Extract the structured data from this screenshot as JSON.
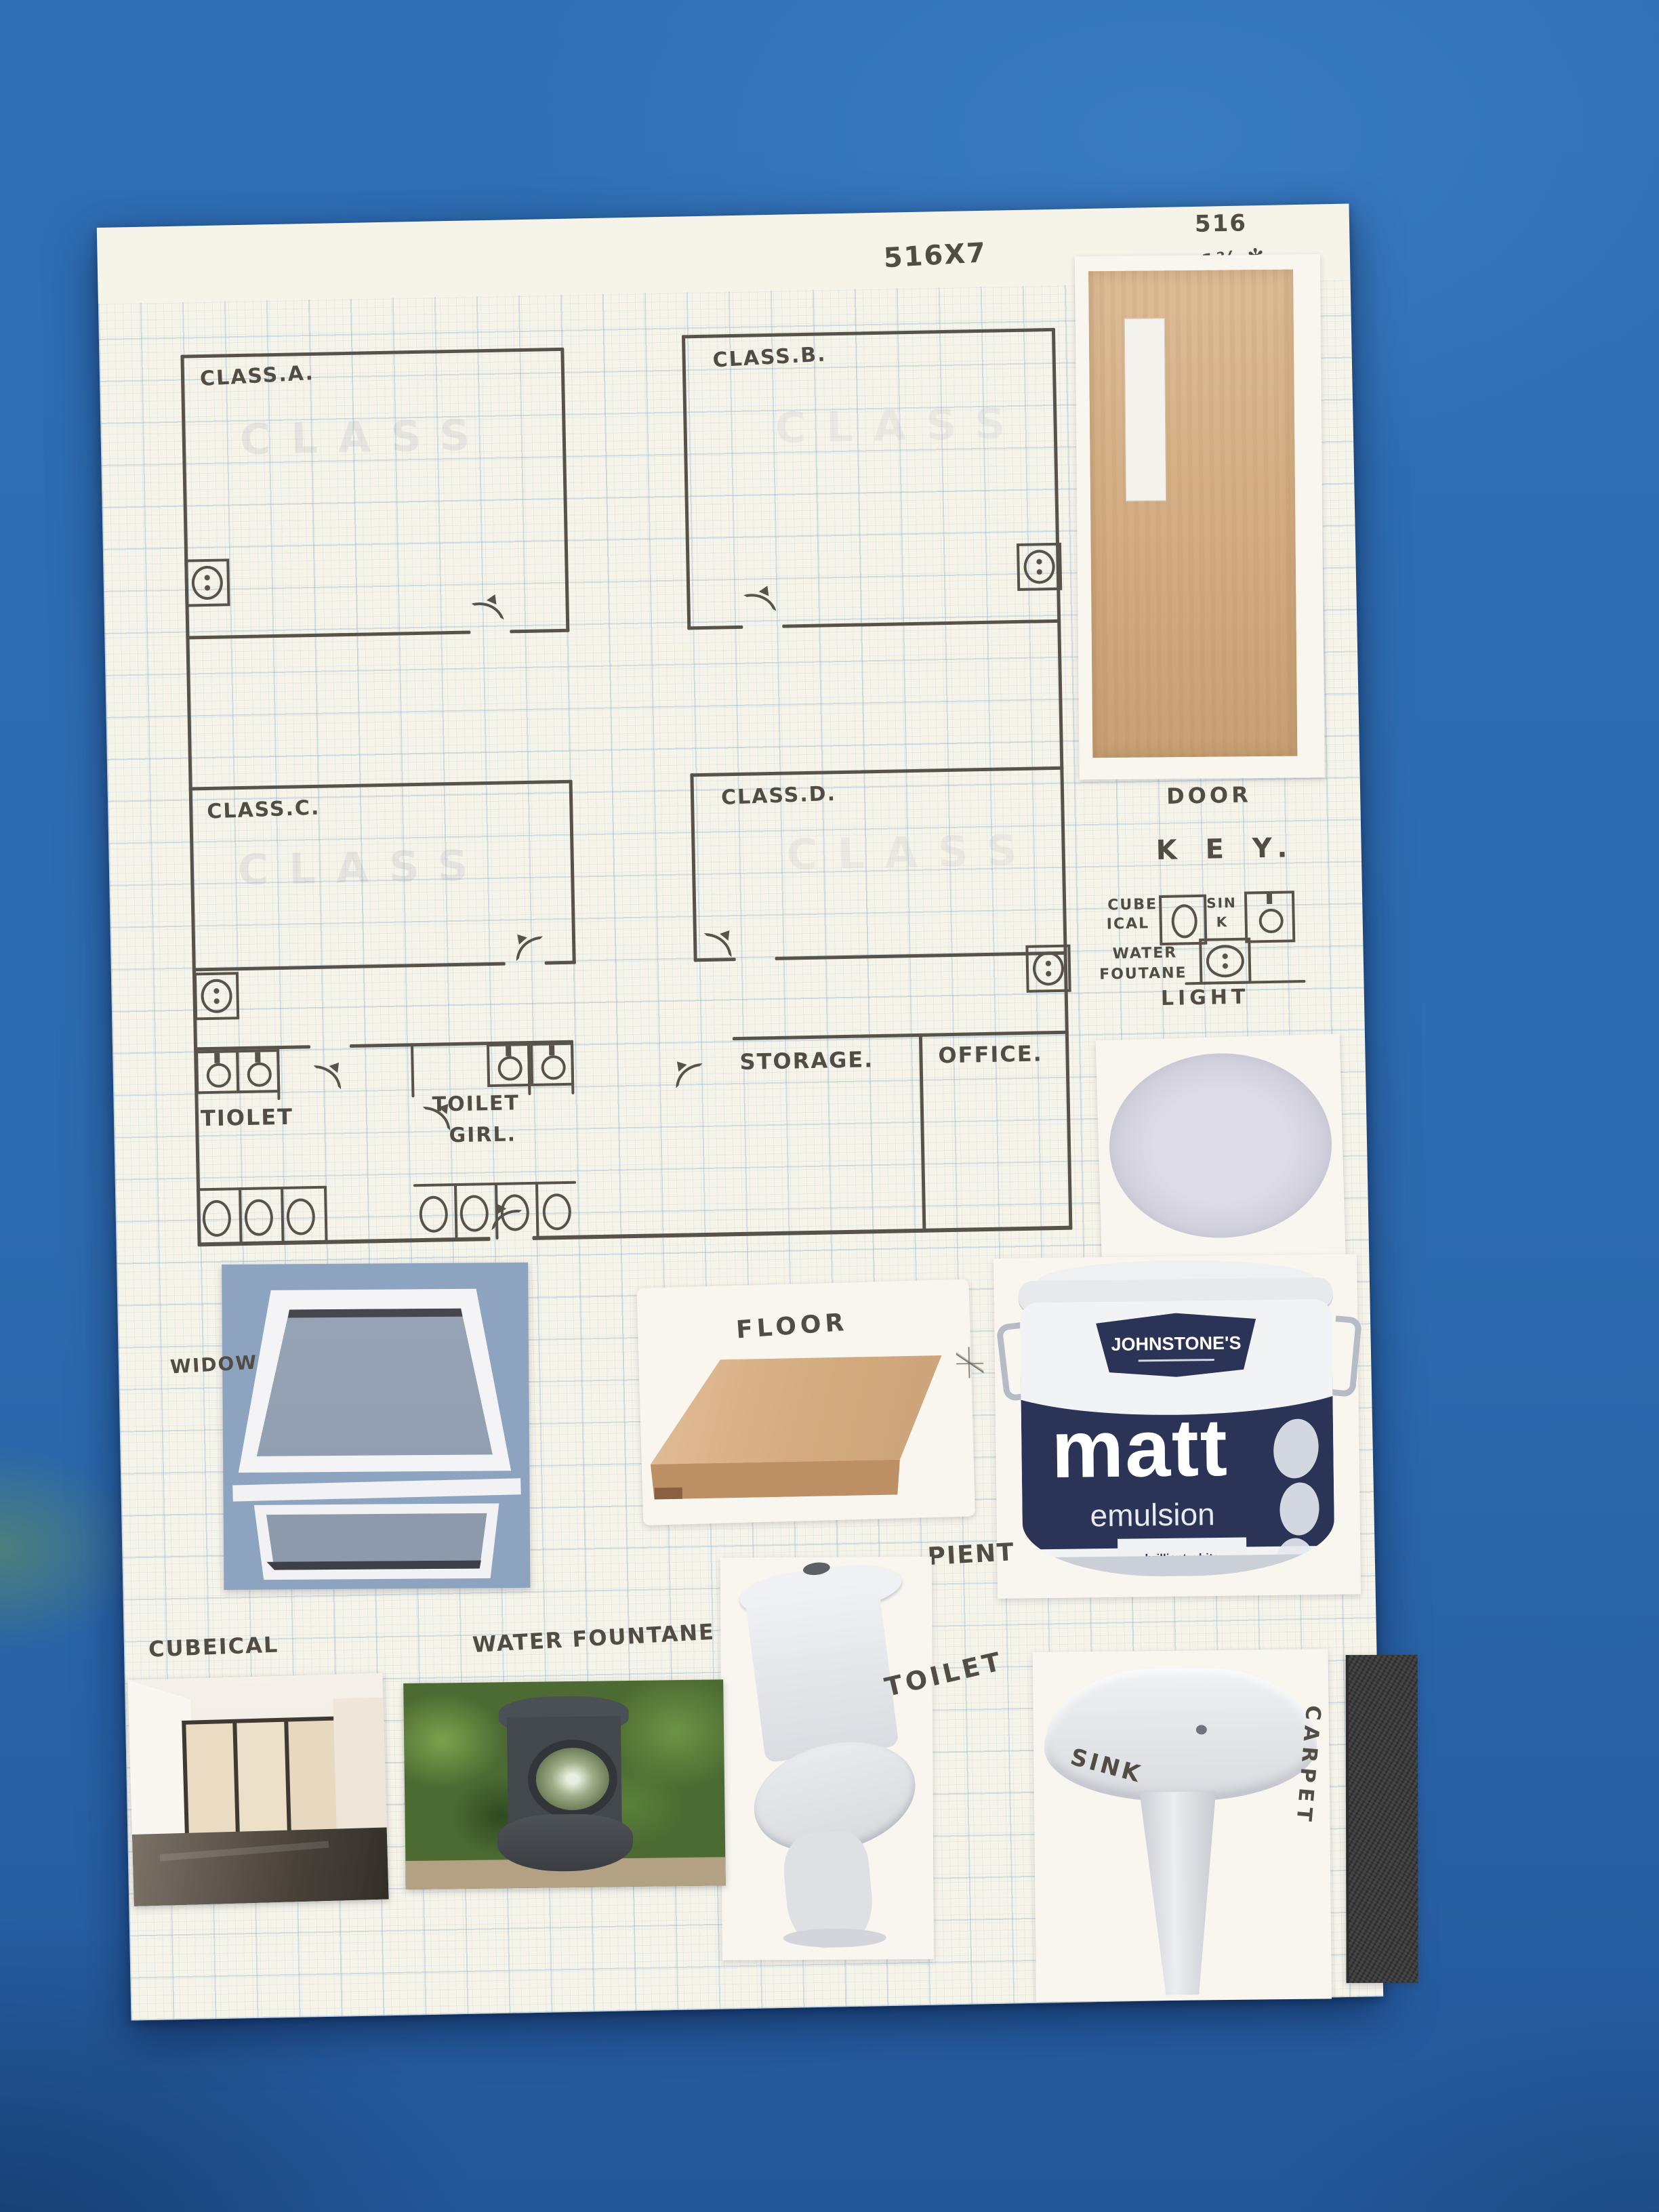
{
  "annotations": {
    "calc1": "516X7",
    "calc2": "516",
    "calc3": "3 6 1⅔ ✻"
  },
  "plan": {
    "class_a": "CLASS.A.",
    "class_b": "CLASS.B.",
    "class_c": "CLASS.C.",
    "class_d": "CLASS.D.",
    "storage": "STORAGE.",
    "office": "OFFICE.",
    "toilet_boys": "TIOLET",
    "toilet_girls_line1": "TOILET",
    "toilet_girls_line2": "GIRL.",
    "ghost_text": "CLASS"
  },
  "key": {
    "title": "K E Y.",
    "cubical_line1": "CUBE",
    "cubical_line2": "ICAL",
    "sink_line1": "SIN",
    "sink_line2": "K",
    "fountain_line1": "WATER",
    "fountain_line2": "FOUTANE",
    "light": "LIGHT"
  },
  "cutout_labels": {
    "door": "DOOR",
    "window": "WIDOW",
    "floor": "FLOOR",
    "paint": "PIENT",
    "cubical": "CUBEICAL",
    "water_fountain": "WATER FOUNTANE",
    "toilet": "TOILET",
    "sink": "SINK",
    "carpet": "CARPET"
  },
  "paint_bucket": {
    "brand": "JOHNSTONE'S",
    "product": "matt",
    "subtitle": "emulsion",
    "shade": "brilliant white"
  },
  "colors": {
    "table_blue": "#2e6db4",
    "paper_white": "#f6f3e9",
    "grid_blue": "#9fc3d8",
    "pencil_grey": "#57534a",
    "door_wood": "#d7b48e",
    "bucket_navy": "#2b3356",
    "window_blue": "#8da4c0",
    "carpet_dark": "#3c3c3c"
  }
}
